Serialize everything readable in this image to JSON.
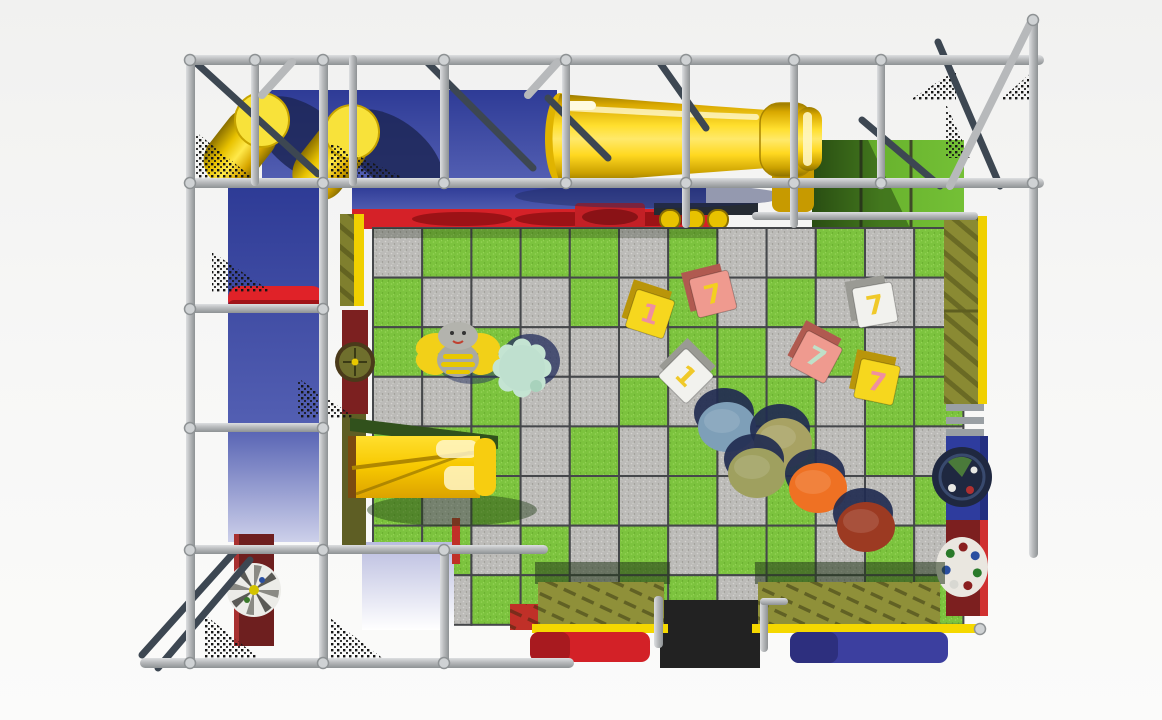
{
  "scene": {
    "description": "Top-down 3D render of an indoor soft-play playground structure",
    "background": "#f5f5f4"
  },
  "palette": {
    "frame_gray": "#b7b9bb",
    "frame_gray_light": "#d8dadc",
    "frame_dark_steel": "#3d4752",
    "wall_blue": "#3a47a3",
    "slide_yellow": "#f7c800",
    "mat_red": "#d32127",
    "cushion_blue": "#3c3f9f",
    "panel_olive": "#8a8a33",
    "edge_yellow": "#f0d000",
    "panel_dark_red": "#7c1f1f",
    "mesh_black": "#161616",
    "entry_mat_black": "#222222",
    "lavender_panel": "#c6c8e6",
    "shadow_navy": "#212b50"
  },
  "floor": {
    "cols": 12,
    "rows": 8,
    "tile_green": "#7cc33e",
    "tile_gray": "#bcbbb8",
    "grout": "#45474a",
    "pattern": [
      "gGGGGgGggGgG",
      "GgggGgGgGggg",
      "GGGgggGGgGgG",
      "ggGggGgGGgGG",
      "GGGgGgGgGgGg",
      "GgGgGgGgGggG",
      "GGgGgGgGGgGg",
      "GgGGgGGgGgGG"
    ]
  },
  "toy_blocks": [
    {
      "name": "toy-block-yellow-1",
      "face": "#f6d71e",
      "side": "#b9950a",
      "numeral": "1",
      "numeral_color": "#ef8fa0",
      "x": 650,
      "y": 314,
      "rot": 18
    },
    {
      "name": "toy-block-pink-7",
      "face": "#ef9a8f",
      "side": "#b05a50",
      "numeral": "7",
      "numeral_color": "#f3d01f",
      "x": 713,
      "y": 294,
      "rot": -14
    },
    {
      "name": "toy-block-white-1",
      "face": "#f2f2ee",
      "side": "#9a9a94",
      "numeral": "1",
      "numeral_color": "#f0c929",
      "x": 686,
      "y": 376,
      "rot": 45
    },
    {
      "name": "toy-block-pink-7b",
      "face": "#ef9a8f",
      "side": "#b05a50",
      "numeral": "7",
      "numeral_color": "#bfe0c8",
      "x": 816,
      "y": 357,
      "rot": 28
    },
    {
      "name": "toy-block-white-7",
      "face": "#f2f2ee",
      "side": "#9a9a94",
      "numeral": "7",
      "numeral_color": "#f0c929",
      "x": 875,
      "y": 305,
      "rot": -10
    },
    {
      "name": "toy-block-yellow-7",
      "face": "#f6d71e",
      "side": "#b9950a",
      "numeral": "7",
      "numeral_color": "#ef8fa0",
      "x": 877,
      "y": 382,
      "rot": 12
    }
  ],
  "stepping_stones": [
    {
      "color": "#7e9fb8",
      "x": 727,
      "y": 427
    },
    {
      "color": "#a8a263",
      "x": 783,
      "y": 443
    },
    {
      "color": "#9fa05f",
      "x": 757,
      "y": 473
    },
    {
      "color": "#ef7123",
      "x": 818,
      "y": 488
    },
    {
      "color": "#9c3a22",
      "x": 866,
      "y": 527
    }
  ],
  "deck": {
    "red_disc_centers": [
      462,
      565,
      650
    ],
    "roller_count": 3
  },
  "animals": [
    {
      "name": "bee-ride",
      "x": 458,
      "y": 352
    },
    {
      "name": "turtle-ride",
      "x": 522,
      "y": 368
    }
  ]
}
